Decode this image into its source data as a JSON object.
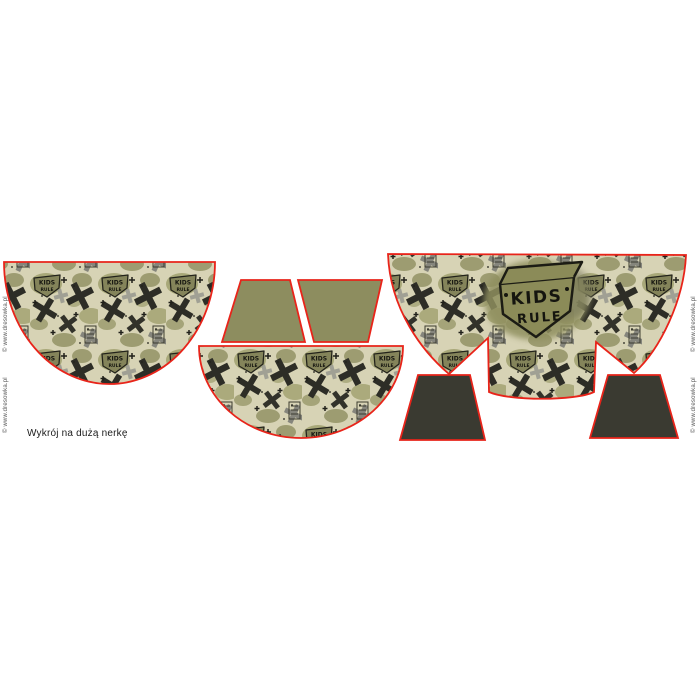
{
  "sheet": {
    "title": "Wykrój na dużą nerkę"
  },
  "watermark": {
    "text": "© www.dresowka.pl"
  },
  "fabric": {
    "badge_line1": "KIDS",
    "badge_line2": "RULE",
    "big_badge_line1": "KIDS",
    "big_badge_line2": "RULE"
  },
  "pieces": {
    "count": 7,
    "camo_pieces": 3,
    "olive_trapezoids": 2,
    "dark_trapezoids": 2
  },
  "colors": {
    "background": "#ffffff",
    "cut_outline_red": "#e8241a",
    "fabric_base_khaki": "#d7d3b5",
    "olive_blob_light": "#a3a372",
    "olive_blob_mid": "#8e8e60",
    "olive_solid_trapezoid": "#8d8d5f",
    "dark_solid_trapezoid": "#3a3a31",
    "x_black": "#2d2d26",
    "x_gray": "#85857c",
    "badge_olive": "#84845a",
    "ink_dark": "#1c1c14",
    "label_text": "#1b1b1b",
    "watermark_text": "#555555"
  }
}
